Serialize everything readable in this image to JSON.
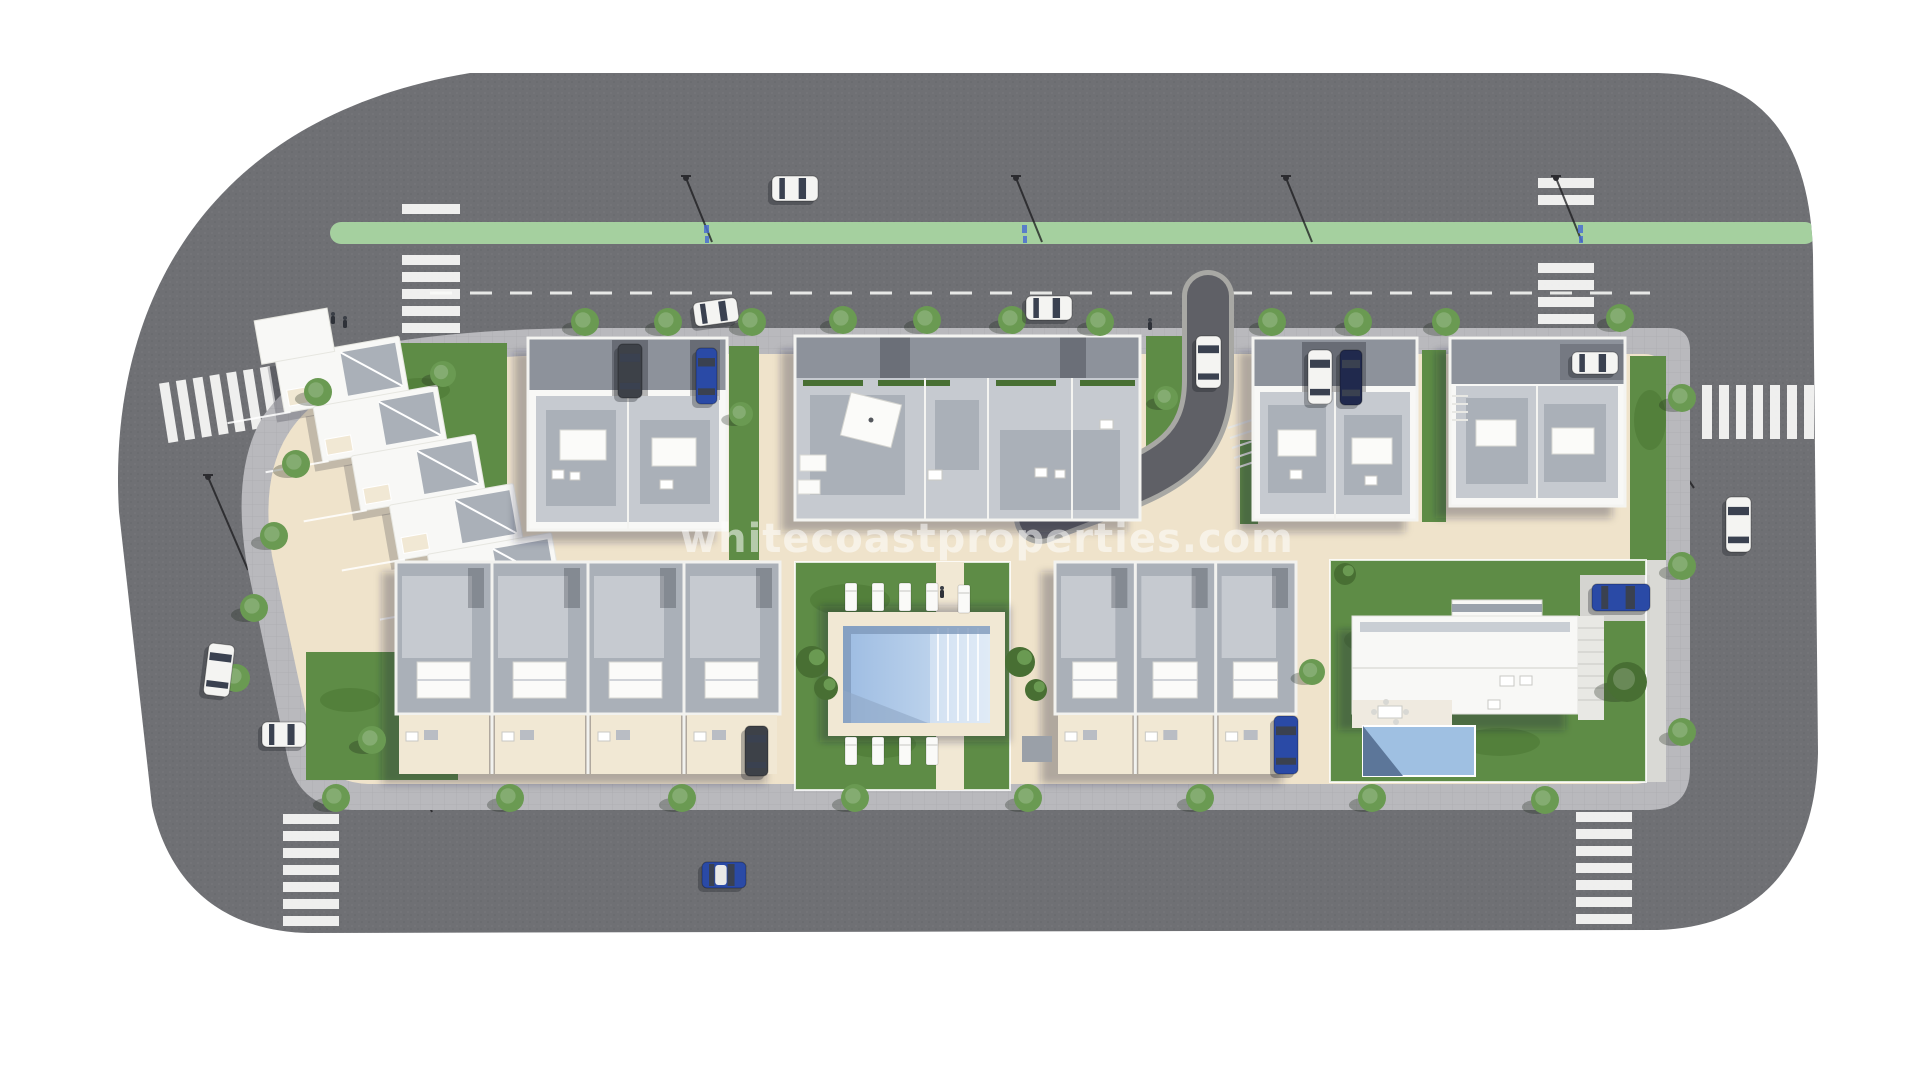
{
  "watermark": {
    "text": "whitecoastproperties.com"
  },
  "palette": {
    "background": "#ffffff",
    "asphalt": "#6f7074",
    "asphalt_dark": "#5f6064",
    "sidewalk": "#b9b9bd",
    "bike_lane": "#a5d09f",
    "ground": "#efe3cb",
    "deck": "#f1e8d4",
    "lawn": "#5e8c46",
    "lawn_dark": "#46702f",
    "wall_white": "#f8f8f6",
    "roof_light": "#c6cad0",
    "roof_mid": "#aab0b8",
    "roof_dark": "#8d929b",
    "marking_white": "#f5f5f3",
    "pool_light": "#cfe0f2",
    "pool_mid": "#9dbce2",
    "pool_shadow": "#7e98ba",
    "tree_green": "#6a9a52",
    "tree_dark": "#486f33",
    "car_white": "#f4f4f2",
    "car_blue": "#2a4aa6",
    "car_navy": "#20294d",
    "car_gray": "#3d4148",
    "glass": "#3a4150",
    "shadow": "rgba(35,38,52,0.30)"
  },
  "scene": {
    "trees": [
      [
        585,
        322
      ],
      [
        668,
        322
      ],
      [
        752,
        322
      ],
      [
        843,
        320
      ],
      [
        927,
        320
      ],
      [
        1012,
        320
      ],
      [
        1100,
        322
      ],
      [
        1272,
        322
      ],
      [
        1358,
        322
      ],
      [
        1446,
        322
      ],
      [
        1620,
        318
      ],
      [
        318,
        392
      ],
      [
        296,
        464
      ],
      [
        274,
        536
      ],
      [
        254,
        608
      ],
      [
        236,
        678
      ],
      [
        336,
        798
      ],
      [
        510,
        798
      ],
      [
        682,
        798
      ],
      [
        855,
        798
      ],
      [
        1028,
        798
      ],
      [
        1200,
        798
      ],
      [
        1372,
        798
      ],
      [
        1545,
        800
      ],
      [
        1682,
        398
      ],
      [
        1682,
        566
      ],
      [
        1682,
        732
      ],
      [
        443,
        374,
        13
      ],
      [
        741,
        414,
        12
      ],
      [
        1166,
        398,
        12
      ],
      [
        372,
        740,
        14
      ],
      [
        1312,
        672,
        13
      ],
      [
        1627,
        682,
        20,
        "dark"
      ]
    ],
    "bushes": [
      [
        812,
        662,
        16
      ],
      [
        826,
        688,
        12
      ],
      [
        1020,
        662,
        15
      ],
      [
        1036,
        690,
        11
      ],
      [
        1345,
        574,
        11
      ]
    ],
    "lawn_patches": [
      [
        850,
        600,
        40,
        16
      ],
      [
        950,
        700,
        50,
        18
      ],
      [
        880,
        744,
        36,
        14
      ],
      [
        1390,
        640,
        46,
        16
      ],
      [
        1500,
        742,
        40,
        14
      ],
      [
        420,
        390,
        30,
        12
      ],
      [
        350,
        700,
        30,
        12
      ],
      [
        1650,
        420,
        16,
        30
      ]
    ],
    "crosswalks": [
      {
        "name": "crosswalk-north-west",
        "orient": "v",
        "cx": 431,
        "y0": 204,
        "count": 8,
        "step": 17,
        "sw": 58,
        "sh": 10,
        "skip": [
          221,
          247
        ]
      },
      {
        "name": "crosswalk-north-east",
        "orient": "v",
        "cx": 1566,
        "y0": 178,
        "count": 9,
        "step": 17,
        "sw": 56,
        "sh": 10,
        "skip": [
          221,
          247
        ]
      },
      {
        "name": "crosswalk-west",
        "orient": "h",
        "x0": 163,
        "cy": 404,
        "count": 7,
        "step": 17,
        "sw": 10,
        "sh": 60,
        "rot": -9
      },
      {
        "name": "crosswalk-south-west",
        "orient": "v",
        "cx": 311,
        "y0": 814,
        "count": 7,
        "step": 17,
        "sw": 56,
        "sh": 10
      },
      {
        "name": "crosswalk-south-east",
        "orient": "v",
        "cx": 1604,
        "y0": 812,
        "count": 7,
        "step": 17,
        "sw": 56,
        "sh": 10
      },
      {
        "name": "crosswalk-east",
        "orient": "h",
        "x0": 1702,
        "cy": 412,
        "count": 7,
        "step": 17,
        "sw": 10,
        "sh": 54
      }
    ],
    "streetlights": [
      [
        686,
        178,
        712,
        242
      ],
      [
        1016,
        178,
        1042,
        242
      ],
      [
        1286,
        178,
        1312,
        242
      ],
      [
        1556,
        178,
        1582,
        242
      ],
      [
        1666,
        447,
        1694,
        488
      ],
      [
        408,
        757,
        432,
        812
      ],
      [
        1252,
        755,
        1276,
        806
      ],
      [
        208,
        477,
        248,
        570
      ]
    ],
    "bike_markings": [
      706,
      1024,
      1580
    ],
    "cars": [
      {
        "name": "car-sedan-white-top-road",
        "x": 772,
        "y": 176,
        "w": 46,
        "h": 25,
        "color": "car_white",
        "rot": 0
      },
      {
        "name": "car-parked-white-top-left",
        "x": 694,
        "y": 300,
        "w": 44,
        "h": 24,
        "color": "car_white",
        "rot": -8
      },
      {
        "name": "car-parked-white-top-mid",
        "x": 1026,
        "y": 296,
        "w": 46,
        "h": 24,
        "color": "car_white",
        "rot": 0
      },
      {
        "name": "car-white-on-driveway",
        "x": 1196,
        "y": 336,
        "w": 25,
        "h": 52,
        "color": "car_white",
        "rot": 0
      },
      {
        "name": "car-suv-white-parked",
        "x": 1308,
        "y": 350,
        "w": 24,
        "h": 54,
        "color": "car_white",
        "rot": 0
      },
      {
        "name": "car-navy-parked",
        "x": 1340,
        "y": 350,
        "w": 22,
        "h": 55,
        "color": "car_navy",
        "rot": 0
      },
      {
        "name": "car-blue-parked-block-a",
        "x": 696,
        "y": 348,
        "w": 21,
        "h": 56,
        "color": "car_blue",
        "rot": 0
      },
      {
        "name": "car-gray-van-parked",
        "x": 618,
        "y": 344,
        "w": 24,
        "h": 54,
        "color": "car_gray",
        "rot": 0
      },
      {
        "name": "car-white-carport-east",
        "x": 1572,
        "y": 352,
        "w": 46,
        "h": 22,
        "color": "car_white",
        "rot": 0
      },
      {
        "name": "car-white-right-road",
        "x": 1726,
        "y": 497,
        "w": 25,
        "h": 55,
        "color": "car_white",
        "rot": 0
      },
      {
        "name": "car-white-left-curb",
        "x": 206,
        "y": 644,
        "w": 26,
        "h": 52,
        "color": "car_white",
        "rot": 7
      },
      {
        "name": "car-white-carport-southwest",
        "x": 262,
        "y": 722,
        "w": 44,
        "h": 25,
        "color": "car_white",
        "rot": 0
      },
      {
        "name": "car-dark-parked-south",
        "x": 745,
        "y": 726,
        "w": 23,
        "h": 50,
        "color": "car_gray",
        "rot": 0
      },
      {
        "name": "car-blue-parked-south",
        "x": 1274,
        "y": 716,
        "w": 24,
        "h": 58,
        "color": "car_blue",
        "rot": 0
      },
      {
        "name": "car-blue-south-road",
        "x": 702,
        "y": 862,
        "w": 44,
        "h": 26,
        "color": "car_blue",
        "rot": 0,
        "roof": "white"
      },
      {
        "name": "car-blue-villa-drive",
        "x": 1592,
        "y": 584,
        "w": 58,
        "h": 27,
        "color": "car_blue",
        "rot": 0
      }
    ],
    "pedestrians": [
      [
        333,
        316
      ],
      [
        345,
        320
      ],
      [
        1150,
        322
      ],
      [
        942,
        590
      ]
    ],
    "sun_loungers": [
      [
        845,
        583
      ],
      [
        872,
        583
      ],
      [
        899,
        583
      ],
      [
        926,
        583
      ],
      [
        958,
        585
      ],
      [
        845,
        737
      ],
      [
        872,
        737
      ],
      [
        899,
        737
      ],
      [
        926,
        737
      ]
    ],
    "townhouse_rows": [
      {
        "name": "townhouse-row-southwest",
        "x": 396,
        "y": 562,
        "w": 384,
        "units": 4,
        "roof_h": 152,
        "patio_h": 60
      },
      {
        "name": "townhouse-row-southeast",
        "x": 1055,
        "y": 562,
        "w": 241,
        "units": 3,
        "roof_h": 152,
        "patio_h": 60
      }
    ],
    "stepped_row": {
      "x0": 298,
      "y0": 338,
      "dx": 29,
      "dy": 55,
      "count": 6,
      "w": 126,
      "h": 56,
      "rot": -10,
      "cx": 400,
      "cy": 480
    }
  }
}
